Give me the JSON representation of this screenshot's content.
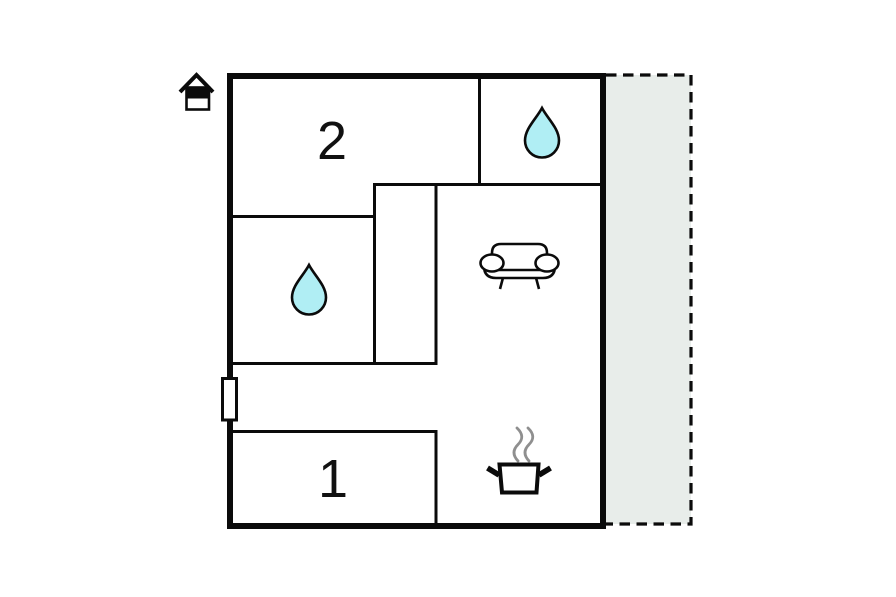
{
  "plan": {
    "rooms": {
      "bedroom_2": {
        "label": "2"
      },
      "bedroom_1": {
        "label": "1"
      }
    },
    "icons": {
      "house": "house-icon",
      "water_drop_bathroom_top": "water-drop-icon",
      "water_drop_bathroom_mid": "water-drop-icon",
      "sofa": "sofa-icon",
      "cooking_pot": "cooking-pot-icon",
      "steam": "steam-icon",
      "door": "door-marker"
    },
    "colors": {
      "walls": "#0b0b0b",
      "room_fill": "#ffffff",
      "water_drop_fill": "#b0eef4",
      "terrace_fill": "#e8edea",
      "steam": "#8f8f8f",
      "label_text": "#111111",
      "background": "#ffffff"
    }
  }
}
